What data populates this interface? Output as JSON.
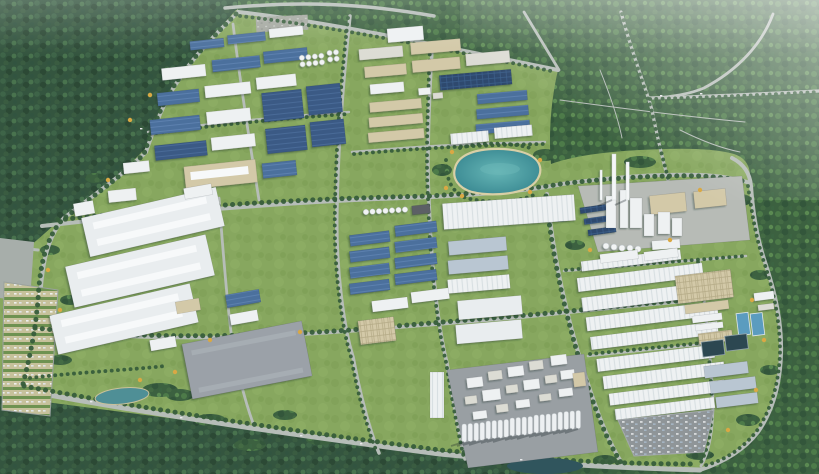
{
  "meta": {
    "type": "3d-aerial-render",
    "caption": "Aerial 3D rendering of a master-planned industrial park: grids of blue-roofed factories, white logistics warehouses, a process plant with chimneys, silo rows, a landscaped lake and tree-lined roads, all surrounded by dense forest.",
    "camera": "high-angle bird's-eye view"
  },
  "palette": {
    "forest_dark": "#34553f",
    "forest_bright": "#3c6140",
    "grass": "#87a75f",
    "road": "#b6bdb8",
    "roof_blue": "#4b6f9d",
    "roof_dark_blue": "#3a5a85",
    "roof_solar": "#2d4a6e",
    "roof_white": "#eef1f2",
    "roof_pale": "#dcdcd4",
    "roof_slate": "#b9c6d2",
    "wall_tan": "#d3c9a8",
    "concrete": "#9aa0a4",
    "lake": "#4aa0a6",
    "pool_bright": "#5b9cbf",
    "pool_dark": "#2c4751",
    "tree_line": "#375d3b",
    "accent_tree": "#d9a844",
    "haze": "#ffffff"
  },
  "scene": {
    "regions": [
      {
        "id": "forest-northwest",
        "label": "Dense forest (northwest)"
      },
      {
        "id": "forest-northeast",
        "label": "Forest with access roads (northeast)"
      },
      {
        "id": "forest-south",
        "label": "Forest belt (south)"
      },
      {
        "id": "forest-east",
        "label": "Forest belt (east)"
      },
      {
        "id": "park-grounds",
        "label": "Industrial park grounds"
      },
      {
        "id": "factory-zone-northwest",
        "label": "Factory cluster with blue metal roofs and tank farm"
      },
      {
        "id": "factory-zone-north-central",
        "label": "Mixed factory blocks with solar roof"
      },
      {
        "id": "lake",
        "label": "Landscaped lake with sandy shore"
      },
      {
        "id": "chemical-plant-east",
        "label": "Process plant with chimneys and towers"
      },
      {
        "id": "warehouse-zone-west",
        "label": "Large white logistics warehouses"
      },
      {
        "id": "logistics-zone-central",
        "label": "Central factory and warehouse blocks"
      },
      {
        "id": "processing-plant-south",
        "label": "Processing plant with silo rows"
      },
      {
        "id": "warehouse-zone-southeast",
        "label": "Long-span warehouse rows"
      },
      {
        "id": "water-treatment",
        "label": "Water treatment basins"
      },
      {
        "id": "parking-lot-west",
        "label": "Tree-lined parking rows"
      },
      {
        "id": "parking-lot-southeast",
        "label": "Staff parking lot"
      },
      {
        "id": "road-network",
        "label": "Tree-lined road grid"
      }
    ],
    "features": {
      "tall_chimneys": 2,
      "lakes": 1,
      "small_ponds": 2,
      "treatment_basins": 4,
      "silo_groups_south_plant": 5,
      "warehouse_rows_southeast": 9
    }
  }
}
